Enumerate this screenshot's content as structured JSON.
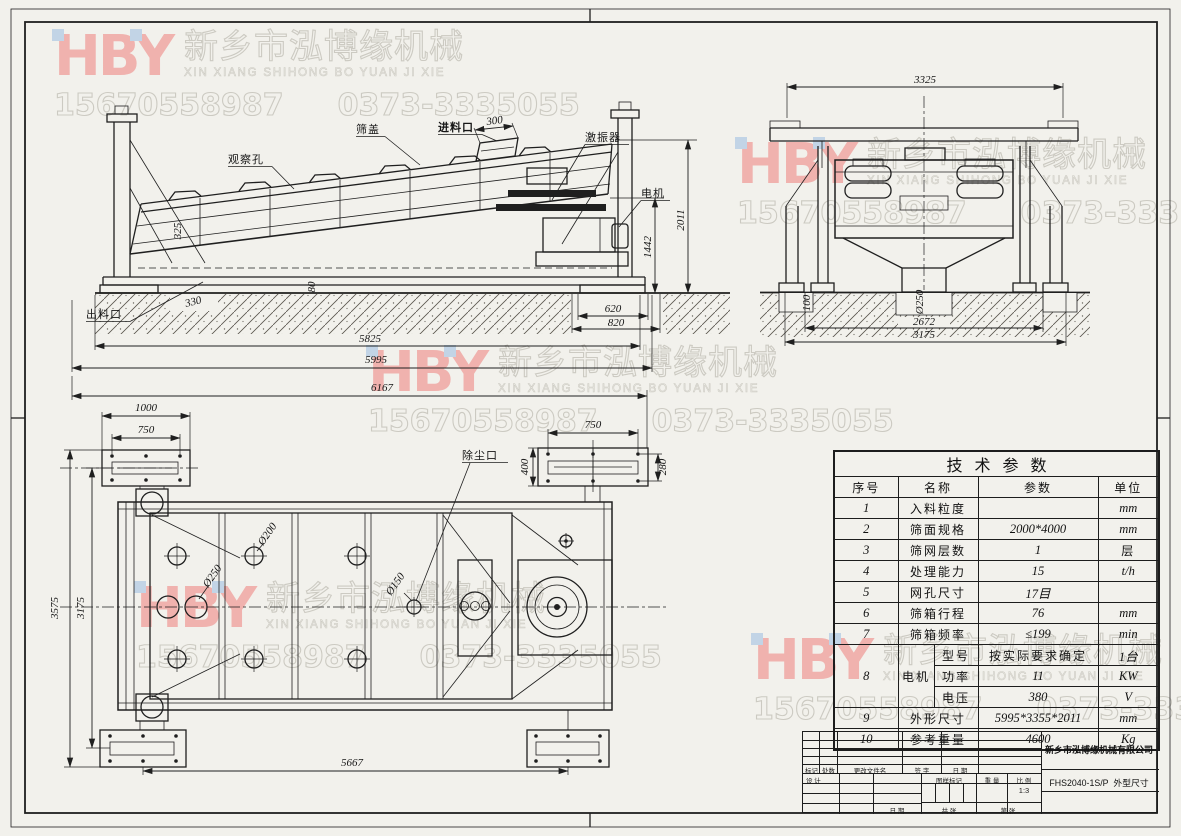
{
  "sheet": {
    "paper_color": "#f2f1ec",
    "line_color": "#1f1f1f"
  },
  "watermark": {
    "logo": "HBY",
    "company_cn": "新乡市泓博缘机械",
    "company_en": "XIN XIANG SHIHONG BO YUAN JI XIE",
    "phone_mobile": "15670558987",
    "phone_tel": "0373-3335055"
  },
  "views": {
    "side": {
      "labels": {
        "observation_hole": "观察孔",
        "screen_cover": "筛盖",
        "feed_inlet": "进料口",
        "exciter": "激振器",
        "motor": "电机",
        "discharge_outlet": "出料口"
      },
      "dims": {
        "d300": "300",
        "d325": "325",
        "d330": "330",
        "d80": "80",
        "d620": "620",
        "d820": "820",
        "d1442": "1442",
        "d2011": "2011",
        "d5825": "5825",
        "d5995": "5995",
        "d6167": "6167"
      }
    },
    "front": {
      "dims": {
        "d3325": "3325",
        "d100": "100",
        "d250": "Ø250",
        "d2672": "2672",
        "d3175": "3175"
      }
    },
    "plan": {
      "labels": {
        "dust_port": "除尘口",
        "hole_250": "Ø250",
        "hole_200": "Ø200",
        "hole_150": "Ø150"
      },
      "dims": {
        "d1000": "1000",
        "d750_left": "750",
        "d750_right": "750",
        "d400": "400",
        "d280": "280",
        "d3575": "3575",
        "d3175": "3175",
        "d5667": "5667"
      }
    }
  },
  "spec_table": {
    "title": "技术参数",
    "headers": {
      "no": "序号",
      "name": "名称",
      "value": "参数",
      "unit": "单位"
    },
    "rows": [
      {
        "no": "1",
        "name": "入料粒度",
        "value": "",
        "unit": "mm"
      },
      {
        "no": "2",
        "name": "筛面规格",
        "value": "2000*4000",
        "unit": "mm"
      },
      {
        "no": "3",
        "name": "筛网层数",
        "value": "1",
        "unit": "层"
      },
      {
        "no": "4",
        "name": "处理能力",
        "value": "15",
        "unit": "t/h"
      },
      {
        "no": "5",
        "name": "网孔尺寸",
        "value": "17目",
        "unit": ""
      },
      {
        "no": "6",
        "name": "筛箱行程",
        "value": "76",
        "unit": "mm"
      },
      {
        "no": "7",
        "name": "筛箱频率",
        "value": "≤199",
        "unit": "min"
      }
    ],
    "motor": {
      "no": "8",
      "name": "电机",
      "rows": [
        {
          "sub": "型号",
          "value": "按实际要求确定",
          "unit": "1台"
        },
        {
          "sub": "功率",
          "value": "11",
          "unit": "KW"
        },
        {
          "sub": "电压",
          "value": "380",
          "unit": "V"
        }
      ]
    },
    "tail": [
      {
        "no": "9",
        "name": "外形尺寸",
        "value": "5995*3355*2011",
        "unit": "mm"
      },
      {
        "no": "10",
        "name": "参考重量",
        "value": "4600",
        "unit": "Kg"
      }
    ]
  },
  "title_block": {
    "company": "新乡市泓博缘机械有限公司",
    "drawing_code": "FHS2040-1S/P",
    "drawing_title": "外型尺寸",
    "scale_value": "1:3",
    "labels": {
      "mark": "标记",
      "count": "处数",
      "change_file": "更改文件名",
      "sign": "签 字",
      "date": "日 期",
      "design": "设 计",
      "date2": "日 期",
      "pattern_mark": "图样标记",
      "weight": "重 量",
      "scale": "比 例",
      "sheets_total": "共  张",
      "sheet_no": "第  张"
    }
  }
}
